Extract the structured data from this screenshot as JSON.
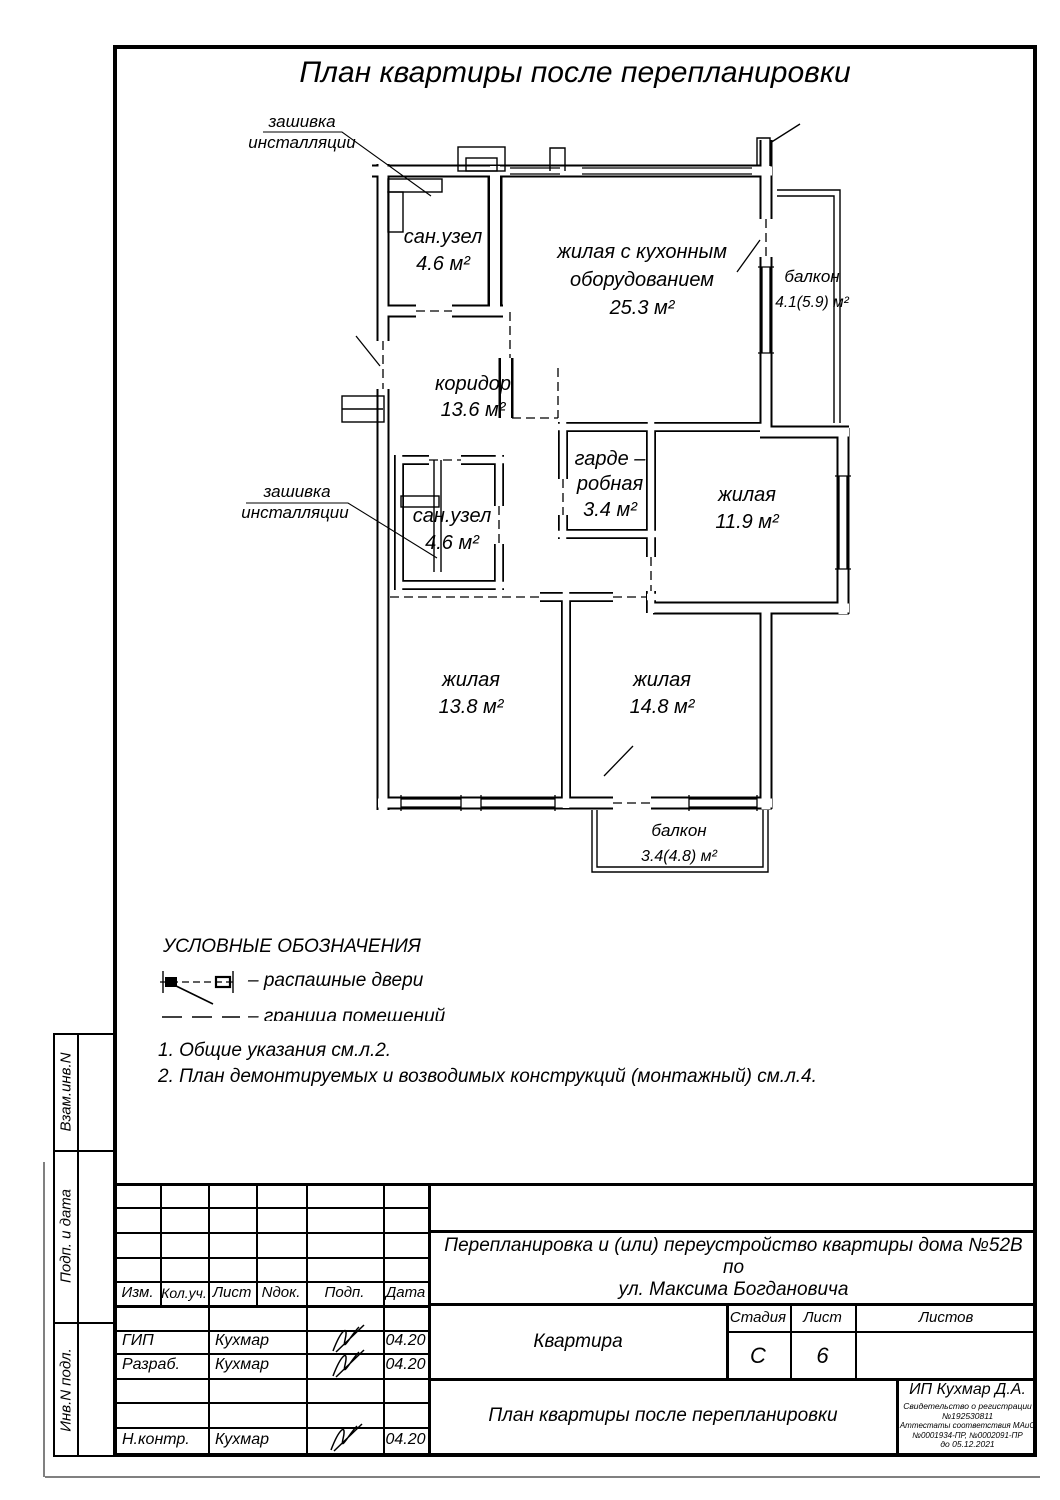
{
  "page": {
    "title": "План квартиры после перепланировки"
  },
  "callouts": {
    "top": {
      "line1": "зашивка",
      "line2": "инсталляции"
    },
    "left": {
      "line1": "зашивка",
      "line2": "инсталляции"
    }
  },
  "rooms": {
    "san1": {
      "name": "сан.узел",
      "area": "4.6 м²"
    },
    "kitchen": {
      "name1": "жилая с кухонным",
      "name2": "оборудованием",
      "area": "25.3 м²"
    },
    "balcony1": {
      "name": "балкон",
      "area": "4.1(5.9) м²"
    },
    "corridor": {
      "name": "коридор",
      "area": "13.6 м²"
    },
    "wardrobe": {
      "name1": "гарде –",
      "name2": "робная",
      "area": "3.4 м²"
    },
    "living119": {
      "name": "жилая",
      "area": "11.9 м²"
    },
    "san2": {
      "name": "сан.узел",
      "area": "4.6 м²"
    },
    "living138": {
      "name": "жилая",
      "area": "13.8 м²"
    },
    "living148": {
      "name": "жилая",
      "area": "14.8 м²"
    },
    "balcony2": {
      "name": "балкон",
      "area": "3.4(4.8) м²"
    }
  },
  "legend": {
    "title": "УСЛОВНЫЕ ОБОЗНАЧЕНИЯ",
    "item1": "–  распашные двери",
    "item2": "–  граница помещений"
  },
  "notes": {
    "n1": "1. Общие указания см.л.2.",
    "n2": "2. План демонтируемых и возводимых конструкций (монтажный) см.л.4."
  },
  "sidebar": {
    "row1": "Взам.инв.N",
    "row2": "Подп. и дата",
    "row3": "Инв.N подл."
  },
  "titleblock": {
    "headers": {
      "izm": "Изм.",
      "kol": "Кол.уч.",
      "list": "Лист",
      "ndok": "Nдок.",
      "podp": "Подп.",
      "data": "Дата"
    },
    "rows": [
      {
        "role": "ГИП",
        "name": "Кухмар",
        "date": "04.20"
      },
      {
        "role": "Разраб.",
        "name": "Кухмар",
        "date": "04.20"
      },
      {
        "role": "Н.контр.",
        "name": "Кухмар",
        "date": "04.20"
      }
    ],
    "doc_title1": "Перепланировка и (или) переустройство квартиры  дома №52В по",
    "doc_title2": "ул. Максима Богдановича",
    "object": "Квартира",
    "stage_label": "Стадия",
    "sheet_label": "Лист",
    "sheets_label": "Листов",
    "stage": "С",
    "sheet": "6",
    "sheets": "",
    "drawing_title": "План квартиры после перепланировки",
    "company": "ИП Кухмар Д.А.",
    "cert1": "Свидетельство о регистрации №192530811",
    "cert2": "Аттестаты соответствия МАиС №0001934-ПР, №0002091-ПР",
    "cert3": "до 05.12.2021"
  }
}
